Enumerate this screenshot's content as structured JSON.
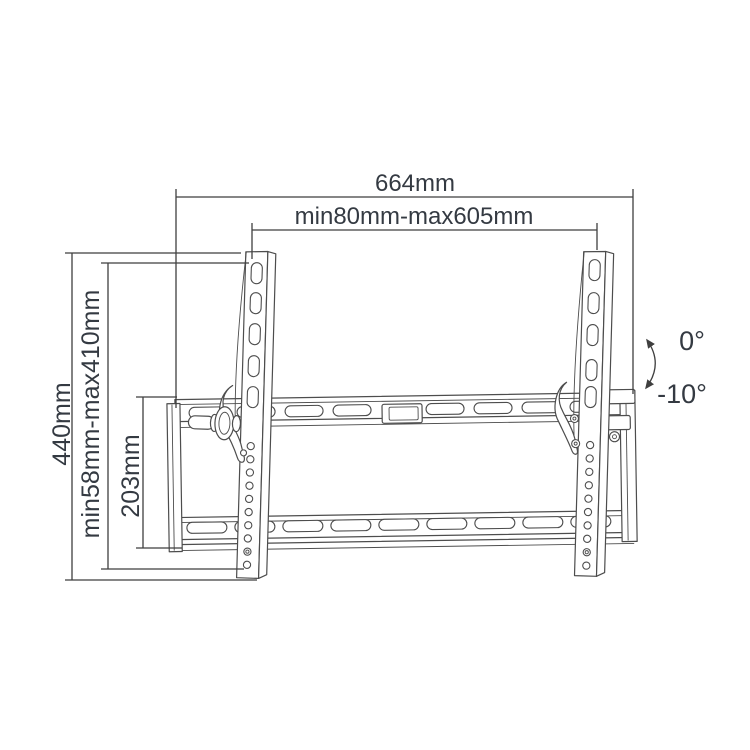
{
  "colors": {
    "background": "#ffffff",
    "line": "#4d4d4d",
    "dim_line": "#3f3f3f",
    "text": "#343a42"
  },
  "dimensions": {
    "overall_width": "664mm",
    "horizontal_range": "min80mm-max605mm",
    "overall_height": "440mm",
    "vertical_range": "min58mm-max410mm",
    "wall_plate_height": "203mm"
  },
  "tilt": {
    "upper": "0°",
    "lower": "-10°"
  }
}
